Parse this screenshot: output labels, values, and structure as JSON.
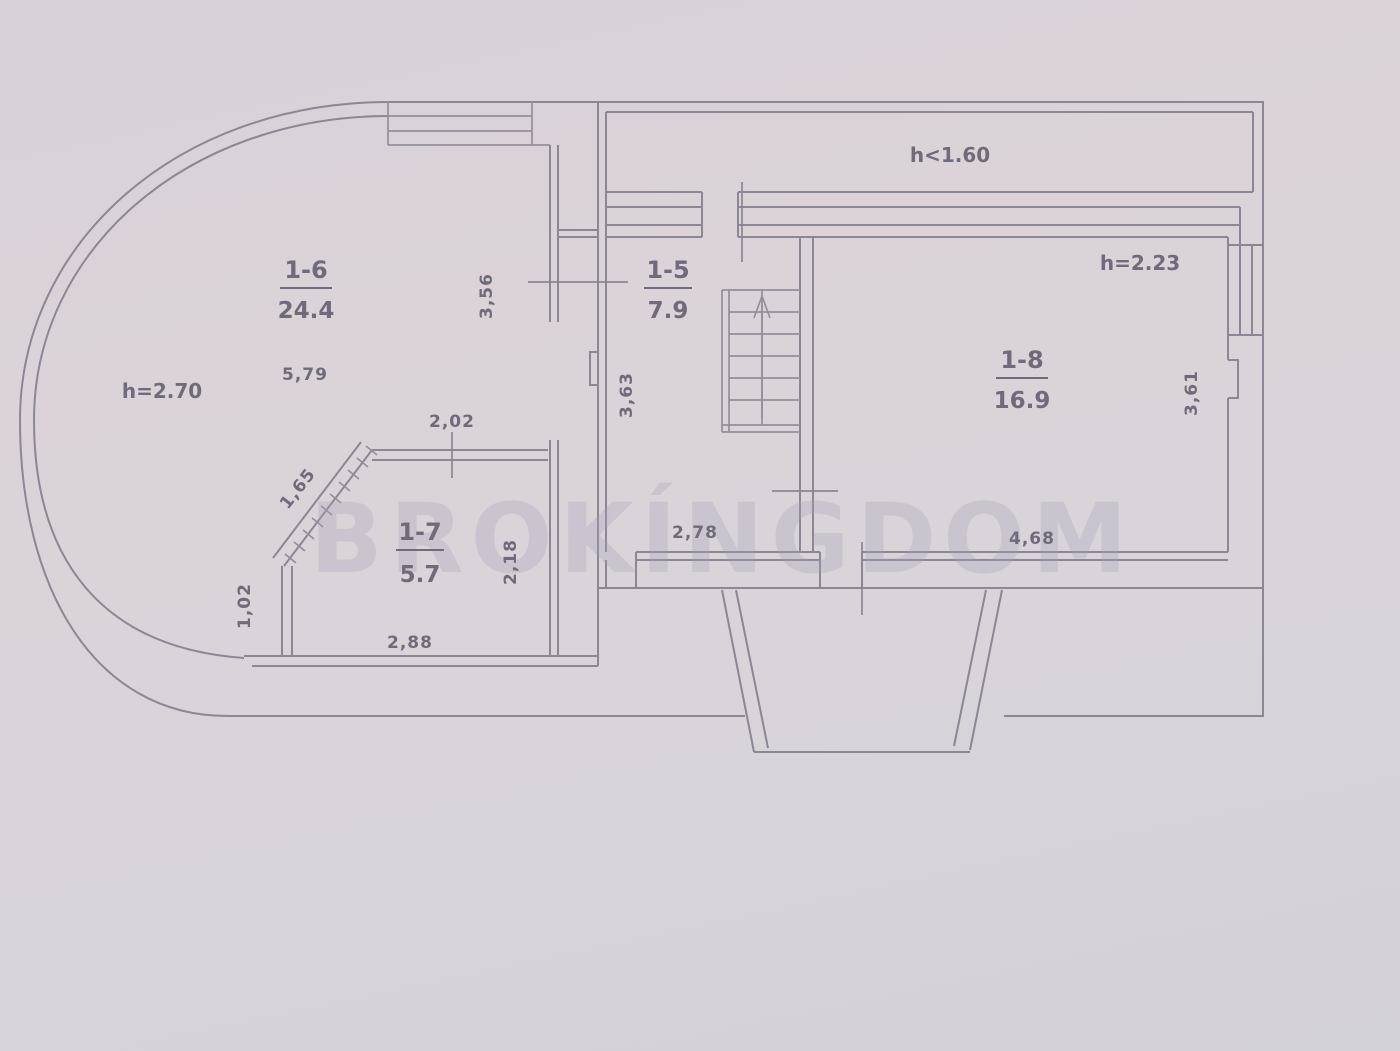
{
  "watermark": "BROKÍNGDOM",
  "attic": {
    "height": "h<1.60"
  },
  "rooms": {
    "r16": {
      "number": "1-6",
      "area": "24.4",
      "height": "h=2.70",
      "width": "5,79",
      "depth": "3,56"
    },
    "r15": {
      "number": "1-5",
      "area": "7.9",
      "depth": "3,63",
      "bottom": "2,78"
    },
    "r17": {
      "number": "1-7",
      "area": "5.7",
      "top": "2,02",
      "diag": "1,65",
      "left": "1,02",
      "bottom": "2,88",
      "right": "2,18"
    },
    "r18": {
      "number": "1-8",
      "area": "16.9",
      "height": "h=2.23",
      "depth": "3,61",
      "bottom": "4,68"
    }
  }
}
